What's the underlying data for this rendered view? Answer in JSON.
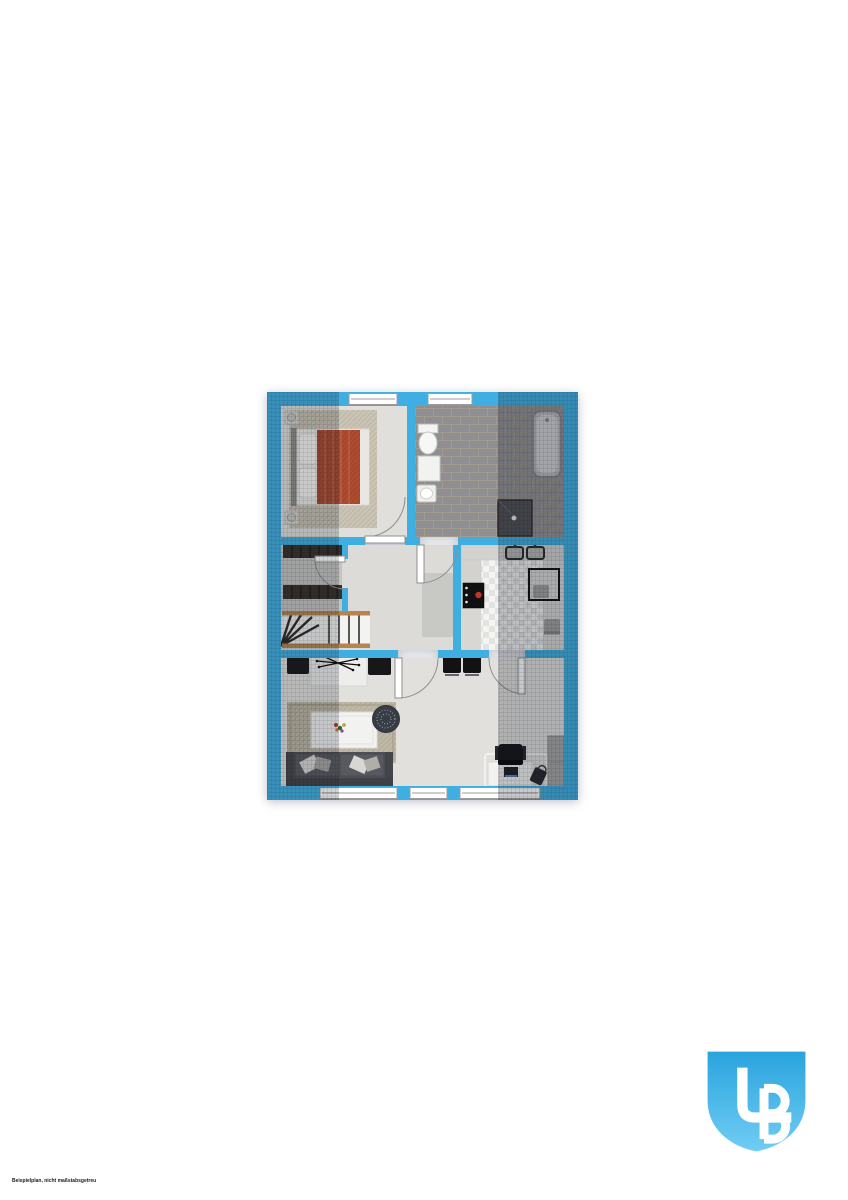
{
  "page": {
    "background_color": "#ffffff"
  },
  "disclaimer": {
    "text": "Beispielplan, nicht maßstabsgetreu"
  },
  "logo": {
    "monogram": "LB",
    "gradient_top": "#2aa4de",
    "gradient_bottom": "#70cdf4",
    "letter_color": "#ffffff"
  },
  "floorplan": {
    "type": "apartment-floor-plan-top-view",
    "windows": 5,
    "doors": 5,
    "colors": {
      "wall": "#3faee0",
      "floor": "#dfdedb",
      "bathroom_tile": "#8e8e93",
      "tile_grout": "#a29a8c",
      "kitchen_tile": "#f4f4f2",
      "bedroom_rug": "#c9c4b3",
      "living_rug": "#beb8a5",
      "bed_duvet": "#ad4a2f",
      "dark_furniture": "#1c1c1f",
      "stairs_wood": "#b5854c",
      "shadow_overlay": "rgba(24,28,40,0.22)"
    },
    "rooms": [
      {
        "name": "bedroom",
        "furniture": [
          "double-bed",
          "bedside-tables",
          "area-rug"
        ]
      },
      {
        "name": "bathroom",
        "furniture": [
          "toilet",
          "vanity-cabinet",
          "washbasin",
          "bathtub",
          "shower"
        ]
      },
      {
        "name": "closet",
        "furniture": [
          "wardrobe-shelves"
        ]
      },
      {
        "name": "stairs",
        "furniture": [
          "winder-staircase"
        ]
      },
      {
        "name": "hallway",
        "furniture": [
          "runner-rug"
        ]
      },
      {
        "name": "kitchen",
        "furniture": [
          "countertop",
          "double-sink",
          "stove",
          "dining-table",
          "chairs"
        ]
      },
      {
        "name": "living-room",
        "furniture": [
          "console-table",
          "chairs",
          "area-rug",
          "coffee-table",
          "flower-vase",
          "pouf",
          "sofa",
          "desk",
          "office-chair",
          "laptop",
          "wardrobe-cabinet"
        ]
      }
    ]
  }
}
